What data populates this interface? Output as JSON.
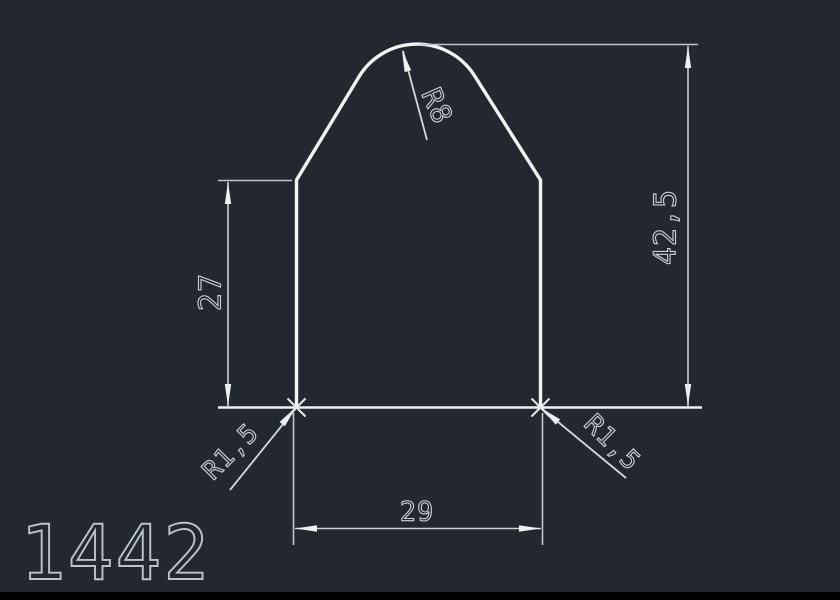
{
  "drawing": {
    "part_label": "1442",
    "dimensions": {
      "height_left": "27",
      "height_total": "42,5",
      "width_bottom": "29",
      "radius_top": "R8",
      "radius_bottom_left": "R1,5",
      "radius_bottom_right": "R1,5"
    },
    "colors": {
      "background": "#222730",
      "outline": "#f2f4f6",
      "dimension_lines": "#ccd1d9",
      "part_label_color": "#bcc2cc",
      "footer_bar": "#000000"
    }
  }
}
